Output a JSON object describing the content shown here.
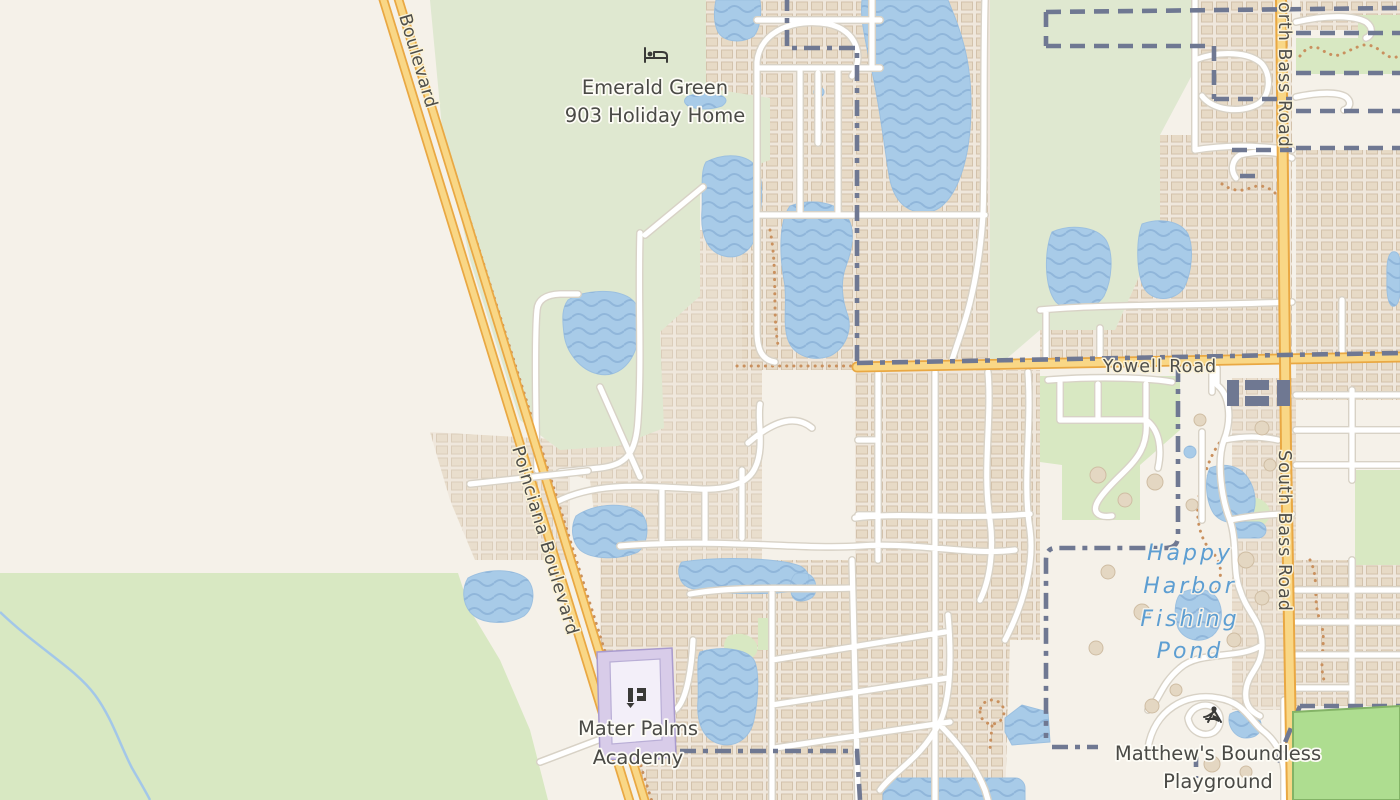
{
  "map": {
    "type": "street-map",
    "roads": {
      "boulevard_partial": "Boulevard",
      "poinciana": "Poinciana Boulevard",
      "yowell": "Yowell Road",
      "north_bass_partial": "orth Bass Road",
      "south_bass": "South Bass Road"
    },
    "pois": {
      "emerald": {
        "line1": "Emerald Green",
        "line2": "903 Holiday Home",
        "icon": "lodging-icon"
      },
      "mater": {
        "line1": "Mater Palms",
        "line2": "Academy",
        "icon": "school-icon"
      },
      "matthews": {
        "line1": "Matthew's Boundless",
        "line2": "Playground",
        "icon": "playground-icon"
      },
      "happy": {
        "line1": "Happy",
        "line2": "Harbor",
        "line3": "Fishing",
        "line4": "Pond"
      }
    },
    "colors": {
      "background": "#f5f1e9",
      "residential": "#efe7dc",
      "grass_top": "#dfe8d0",
      "grass": "#d8e8c2",
      "pitch": "#aedd90",
      "water": "#a8cbe8",
      "major_road_fill": "#f9d786",
      "major_road_casing": "#e9a843",
      "minor_road": "#ffffff",
      "boundary": "#6f7892",
      "path_dots": "#c9905e",
      "poi_text": "#4a4a46",
      "water_text": "#5d9ed2",
      "school_area": "#d8cce9"
    }
  }
}
